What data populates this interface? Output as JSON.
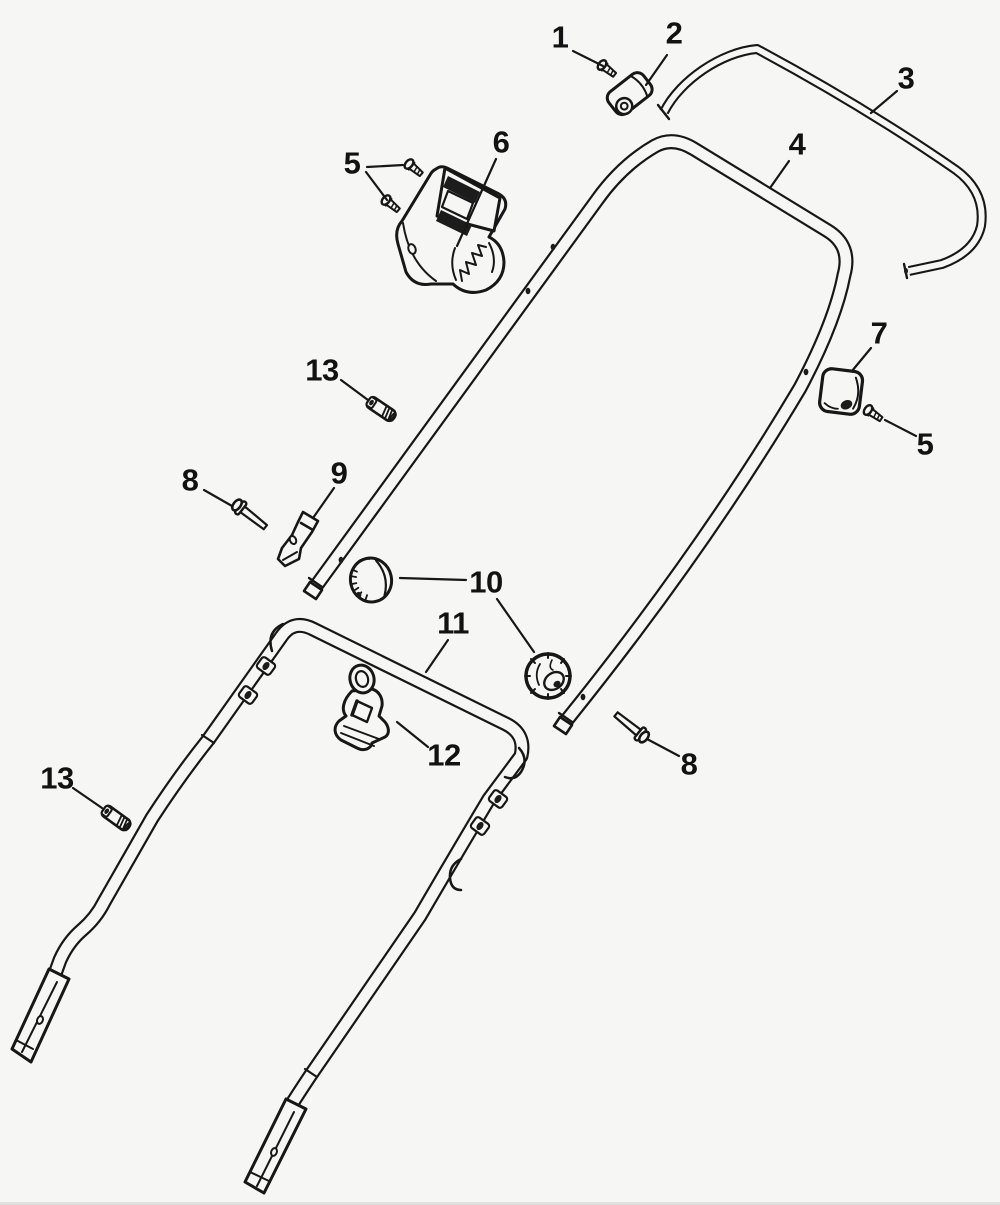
{
  "page": {
    "background_color": "#f6f6f5",
    "artwork_line_color": "#171717",
    "bottom_edge_color": "#e0e0de"
  },
  "diagram": {
    "kind": "exploded-parts-diagram",
    "subject": "handle-assembly",
    "callouts": [
      {
        "part": "1",
        "label_x": 560,
        "label_y": 37,
        "leaders": [
          [
            573,
            51,
            603,
            66
          ]
        ]
      },
      {
        "part": "2",
        "label_x": 674,
        "label_y": 33,
        "leaders": [
          [
            667,
            55,
            646,
            85
          ]
        ]
      },
      {
        "part": "3",
        "label_x": 906,
        "label_y": 78,
        "leaders": [
          [
            897,
            91,
            871,
            113
          ]
        ]
      },
      {
        "part": "4",
        "label_x": 797,
        "label_y": 144,
        "leaders": [
          [
            789,
            161,
            770,
            188
          ]
        ]
      },
      {
        "part": "5",
        "label_x": 352,
        "label_y": 163,
        "leaders": [
          [
            367,
            167,
            403,
            165
          ],
          [
            366,
            172,
            387,
            200
          ]
        ]
      },
      {
        "part": "6",
        "label_x": 501,
        "label_y": 142,
        "leaders": [
          [
            496,
            159,
            457,
            246
          ]
        ]
      },
      {
        "part": "7",
        "label_x": 879,
        "label_y": 333,
        "leaders": [
          [
            871,
            348,
            852,
            371
          ]
        ]
      },
      {
        "part": "5",
        "label_x": 925,
        "label_y": 444,
        "leaders": [
          [
            916,
            436,
            885,
            420
          ]
        ]
      },
      {
        "part": "13",
        "label_x": 322,
        "label_y": 370,
        "leaders": [
          [
            341,
            380,
            368,
            400
          ]
        ]
      },
      {
        "part": "8",
        "label_x": 190,
        "label_y": 480,
        "leaders": [
          [
            204,
            490,
            232,
            506
          ]
        ]
      },
      {
        "part": "9",
        "label_x": 339,
        "label_y": 473,
        "leaders": [
          [
            334,
            488,
            313,
            518
          ]
        ]
      },
      {
        "part": "10",
        "label_x": 486,
        "label_y": 582,
        "leaders": [
          [
            466,
            580,
            400,
            578
          ],
          [
            497,
            599,
            534,
            652
          ]
        ]
      },
      {
        "part": "11",
        "label_x": 453,
        "label_y": 623,
        "leaders": [
          [
            448,
            640,
            426,
            672
          ]
        ]
      },
      {
        "part": "12",
        "label_x": 444,
        "label_y": 755,
        "leaders": [
          [
            428,
            747,
            397,
            722
          ]
        ]
      },
      {
        "part": "13",
        "label_x": 57,
        "label_y": 778,
        "leaders": [
          [
            73,
            788,
            102,
            808
          ]
        ]
      },
      {
        "part": "8",
        "label_x": 689,
        "label_y": 764,
        "leaders": [
          [
            679,
            756,
            647,
            739
          ]
        ]
      }
    ]
  }
}
